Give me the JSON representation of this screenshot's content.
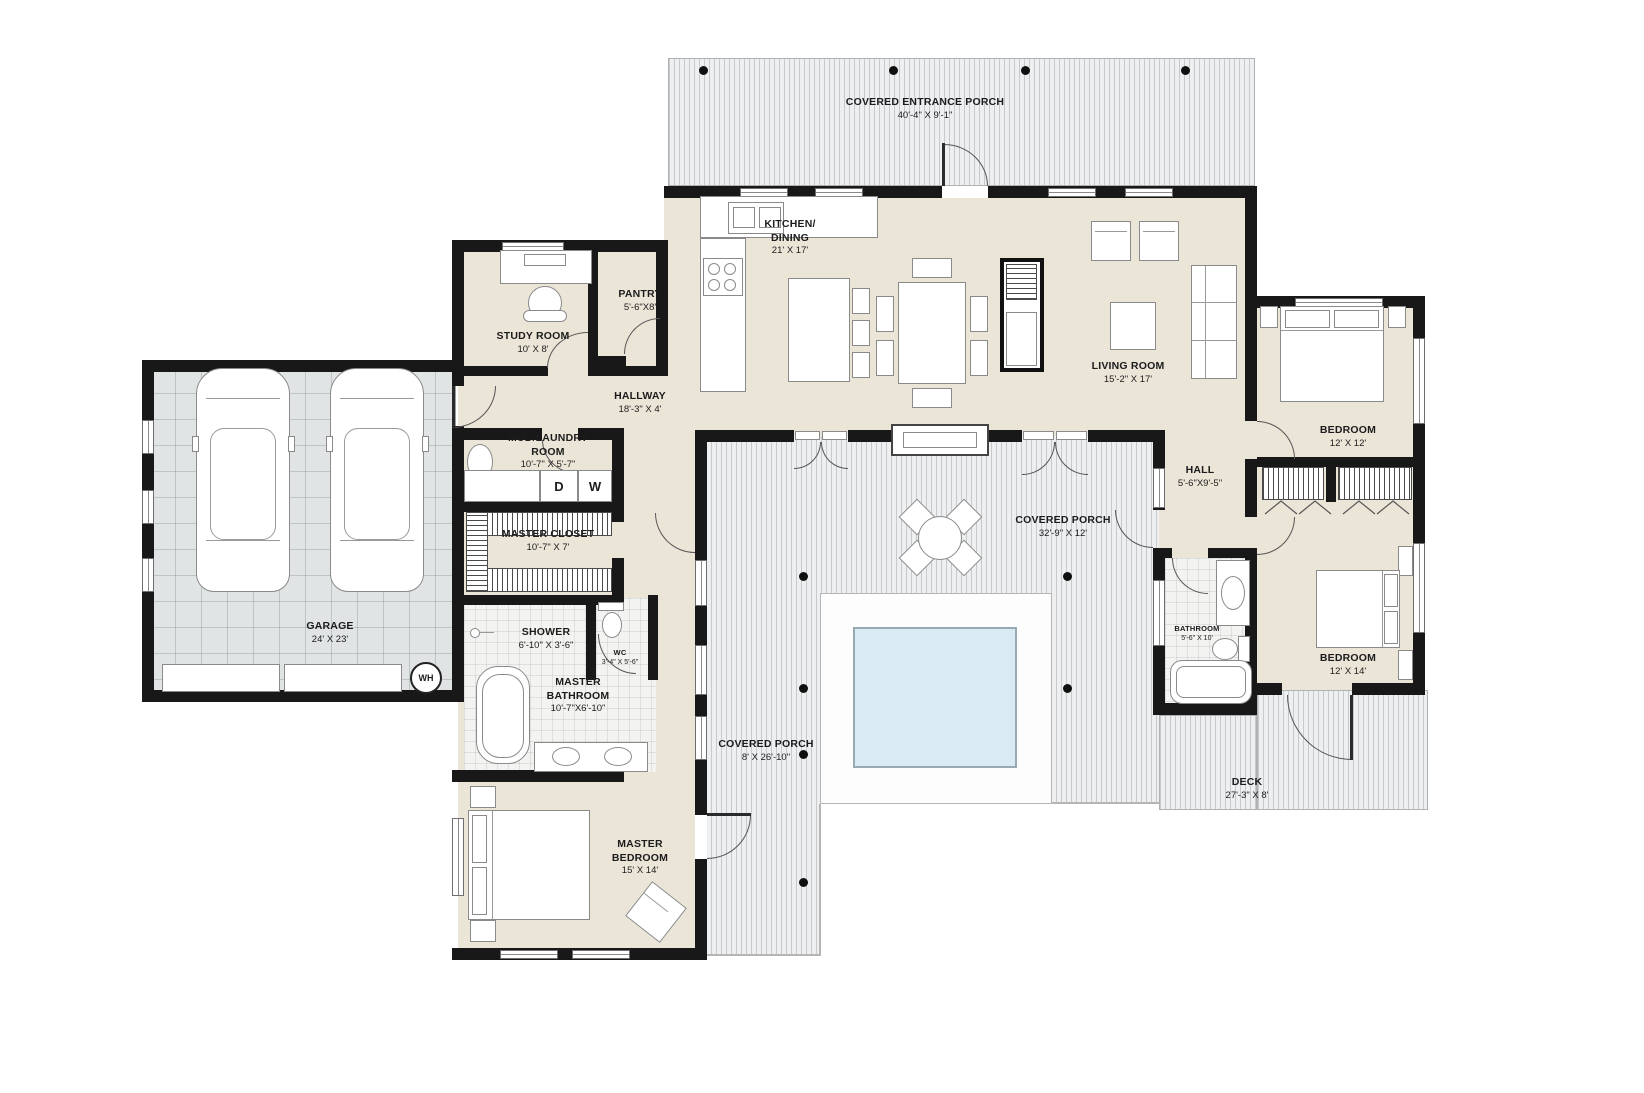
{
  "plan": {
    "title": "single-story house floor plan",
    "colors": {
      "wall": "#181818",
      "interior_floor": "#ebe5d8",
      "porch_stripe": "#edeff0",
      "garage_floor": "#e0e4e4",
      "pool_water": "#d9eaf4"
    },
    "rooms": [
      {
        "id": "covered-entrance-porch",
        "name": "COVERED ENTRANCE PORCH",
        "dims": "40'-4\" X 9'-1\""
      },
      {
        "id": "kitchen-dining",
        "name": "KITCHEN/ DINING",
        "dims": "21' X 17'"
      },
      {
        "id": "living-room",
        "name": "LIVING ROOM",
        "dims": "15'-2\" X 17'"
      },
      {
        "id": "study-room",
        "name": "STUDY ROOM",
        "dims": "10' X 8'"
      },
      {
        "id": "pantry",
        "name": "PANTRY",
        "dims": "5'-6\"X8'"
      },
      {
        "id": "hallway",
        "name": "HALLWAY",
        "dims": "18'-3\" X 4'"
      },
      {
        "id": "mud-laundry-room",
        "name": "MUD/LAUNDRY ROOM",
        "dims": "10'-7\" X 5'-7\""
      },
      {
        "id": "master-closet",
        "name": "MASTER CLOSET",
        "dims": "10'-7\" X 7'"
      },
      {
        "id": "shower",
        "name": "SHOWER",
        "dims": "6'-10\" X 3'-6\""
      },
      {
        "id": "wc",
        "name": "WC",
        "dims": "3'-4\" X 5'-6\""
      },
      {
        "id": "master-bathroom",
        "name": "MASTER BATHROOM",
        "dims": "10'-7\"X6'-10\""
      },
      {
        "id": "master-bedroom",
        "name": "MASTER BEDROOM",
        "dims": "15' X 14'"
      },
      {
        "id": "garage",
        "name": "GARAGE",
        "dims": "24' X 23'"
      },
      {
        "id": "covered-porch-rear",
        "name": "COVERED PORCH",
        "dims": "32'-9\" X 12'"
      },
      {
        "id": "covered-porch-side",
        "name": "COVERED PORCH",
        "dims": "8' X 26'-10\""
      },
      {
        "id": "bedroom-1",
        "name": "BEDROOM",
        "dims": "12' X 12'"
      },
      {
        "id": "hall",
        "name": "HALL",
        "dims": "5'-6\"X9'-5\""
      },
      {
        "id": "bathroom",
        "name": "BATHROOM",
        "dims": "5'-6\" X 10'"
      },
      {
        "id": "bedroom-2",
        "name": "BEDROOM",
        "dims": "12' X 14'"
      },
      {
        "id": "deck",
        "name": "DECK",
        "dims": "27'-3\" X 8'"
      }
    ],
    "appliances": {
      "dryer": "D",
      "washer": "W",
      "water_heater": "WH"
    }
  }
}
